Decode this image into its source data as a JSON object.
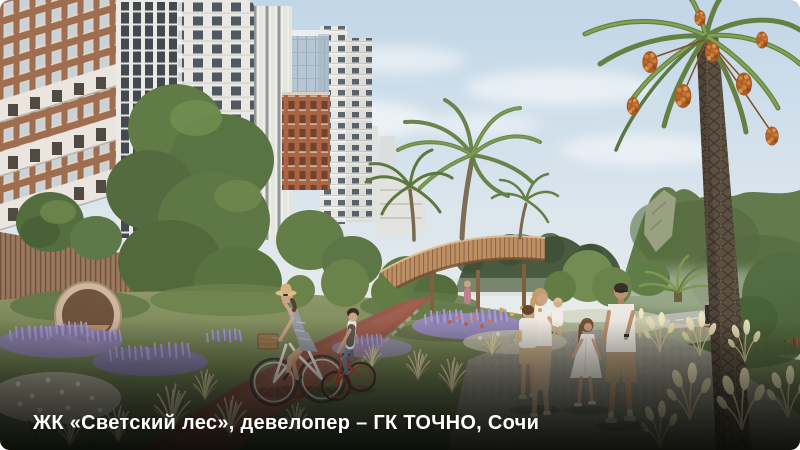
{
  "photo": {
    "kind": "architectural-render",
    "caption": "ЖК «Светский лес», девелопер – ГК ТОЧНО, Сочи",
    "caption_color": "#ffffff",
    "palette": {
      "sky_top": "#bfd6e9",
      "sky_horizon": "#eef1ee",
      "mountain": "#5d7747",
      "terracotta_facade": "#9c6a4c",
      "white_facade": "#e9e9e5",
      "glass_facade": "#b3c6d4",
      "wood_walkway": "#b98a5e",
      "wood_podium": "#8f6e54",
      "foliage": "#57743f",
      "lavender": "#8d80b8",
      "dry_grass": "#d3c79c",
      "bike_path": "#8f5145",
      "gravel_path": "#8f8d81",
      "palm_fruit": "#a8561f"
    },
    "scene_elements": [
      "residential towers with terracotta and white facades",
      "glass tower",
      "round wooden seating pod",
      "large green trees and topiary shrubs",
      "curved wooden walkway on stilts",
      "palm trees",
      "date palm with orange fruit clusters",
      "green mountain with rocky cliff",
      "road with wooden fence and bollard",
      "lavender, white and red flower beds",
      "ornamental grass and pampas clumps",
      "red bike path",
      "woman on white bicycle with basket",
      "boy on red bicycle",
      "family of five on gravel path"
    ]
  }
}
